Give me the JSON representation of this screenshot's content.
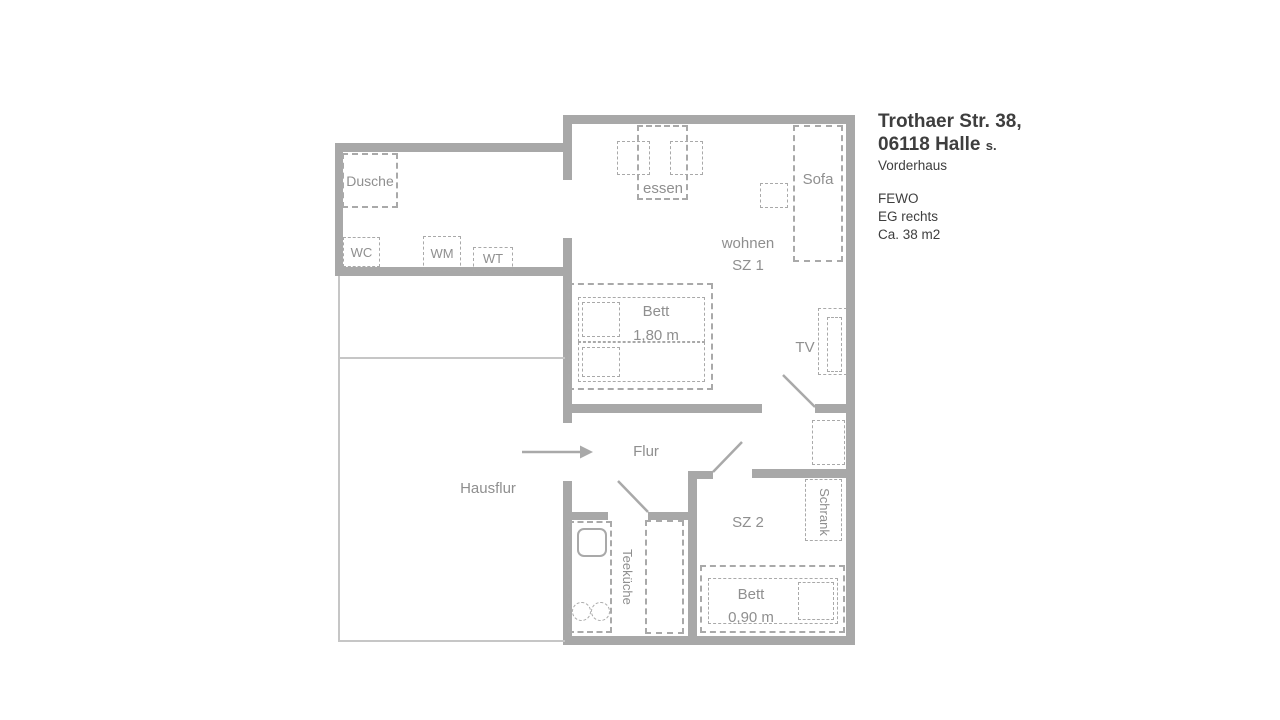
{
  "title_block": {
    "address_line1": "Trothaer Str. 38,",
    "address_line2": "06118 Halle",
    "address_line2_suffix": "s.",
    "building": "Vorderhaus",
    "unit": "FEWO",
    "floor": "EG rechts",
    "area": "Ca. 38 m2"
  },
  "labels": {
    "shower": "Dusche",
    "wc": "WC",
    "washing_machine": "WM",
    "washbasin": "WT",
    "dining": "essen",
    "sofa": "Sofa",
    "living_line1": "wohnen",
    "living_line2": "SZ 1",
    "bed1": "Bett",
    "bed1_size": "1,80 m",
    "tv": "TV",
    "hall": "Flur",
    "house_hall": "Hausflur",
    "bedroom2": "SZ 2",
    "wardrobe": "Schrank",
    "bed2": "Bett",
    "bed2_size": "0,90 m",
    "kitchenette": "Teeküche"
  },
  "colors": {
    "wall": "#a8a8a8",
    "line": "#a9a9a9",
    "label": "#8f8f8f",
    "title": "#3e3e3e",
    "thin": "#c6c6c6"
  }
}
